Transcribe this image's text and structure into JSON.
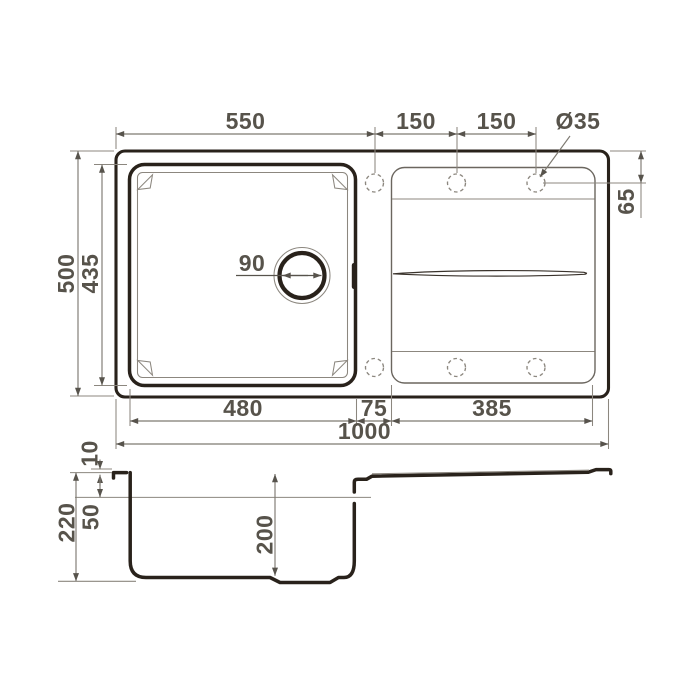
{
  "drawing_labels": {
    "top_width_550": "550",
    "hole_spacing_left_150": "150",
    "hole_spacing_right_150": "150",
    "hole_diameter_35": "Ø35",
    "hole_offset_65": "65",
    "overall_depth_500": "500",
    "bowl_depth_435": "435",
    "drain_diameter_90": "90",
    "bowl_width_480": "480",
    "gap_75": "75",
    "drainboard_width_385": "385",
    "overall_width_1000": "1000",
    "rim_height_10": "10",
    "ledge_depth_50": "50",
    "total_height_220": "220",
    "bowl_height_200": "200"
  },
  "colors": {
    "line_dark": "#29221b",
    "line_medium": "#6b665f",
    "line_light": "#8c877f",
    "dimension_line": "#7e7a72",
    "text": "#57534b",
    "background": "#ffffff"
  }
}
